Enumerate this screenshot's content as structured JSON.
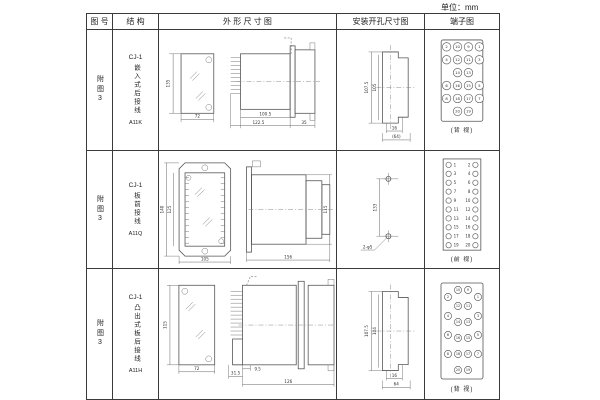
{
  "unit_label": "单位：mm",
  "headers": {
    "fig": "图 号",
    "structure": "结 构",
    "outline": "外 形 尺 寸 图",
    "mounting": "安装开孔尺寸图",
    "terminal": "端子图"
  },
  "rows": [
    {
      "fig": "附图3",
      "model": "CJ-1",
      "mount_type": "嵌入式后接线",
      "code": "A11K",
      "dims": {
        "h": "135",
        "w": "72",
        "body": "100.5",
        "total": "122.5",
        "flange": "35"
      },
      "cutout": {
        "outer": "107.5",
        "inner": "105",
        "slot": "16",
        "width": "(64)"
      },
      "terminal_view": "(背 视)",
      "terminal_grid": [
        [
          "2",
          "10",
          "9",
          "1"
        ],
        [
          "4",
          "12",
          "11",
          "3"
        ],
        [
          "",
          "14",
          "13",
          ""
        ],
        [
          "6",
          "16",
          "15",
          "5"
        ],
        [
          "8",
          "18",
          "17",
          "7"
        ],
        [
          "",
          "20",
          "19",
          ""
        ]
      ]
    },
    {
      "fig": "附图3",
      "model": "CJ-1",
      "mount_type": "板前接线",
      "code": "A11Q",
      "dims": {
        "outer_h": "140",
        "inner_h": "125",
        "w": "105",
        "len": "156",
        "side_h": "115"
      },
      "cutout": {
        "dist": "133",
        "holes": "2-φ5"
      },
      "terminal_view": "(前 视)",
      "terminal_left": [
        "1",
        "3",
        "5",
        "7",
        "9",
        "11",
        "13",
        "15",
        "17",
        "19"
      ],
      "terminal_right": [
        "2",
        "4",
        "6",
        "8",
        "10",
        "12",
        "14",
        "16",
        "18",
        "20"
      ]
    },
    {
      "fig": "附图3",
      "model": "CJ-1",
      "mount_type": "凸出式板后接线",
      "code": "A11H",
      "dims": {
        "h": "115",
        "w": "72",
        "pins": "31.5",
        "gap": "9.5",
        "len": "126"
      },
      "cutout": {
        "outer": "107.5",
        "inner": "104",
        "slot": "16",
        "width": "64"
      },
      "terminal_view": "(背 视)",
      "terminal_cols": {
        "outer_left": [
          "2",
          "4",
          "6",
          "8"
        ],
        "inner_left": [
          "10",
          "12",
          "14",
          "16",
          "18",
          "20"
        ],
        "inner_right": [
          "9",
          "11",
          "13",
          "15",
          "17",
          "19"
        ],
        "outer_right": [
          "1",
          "3",
          "5",
          "7"
        ]
      }
    }
  ]
}
